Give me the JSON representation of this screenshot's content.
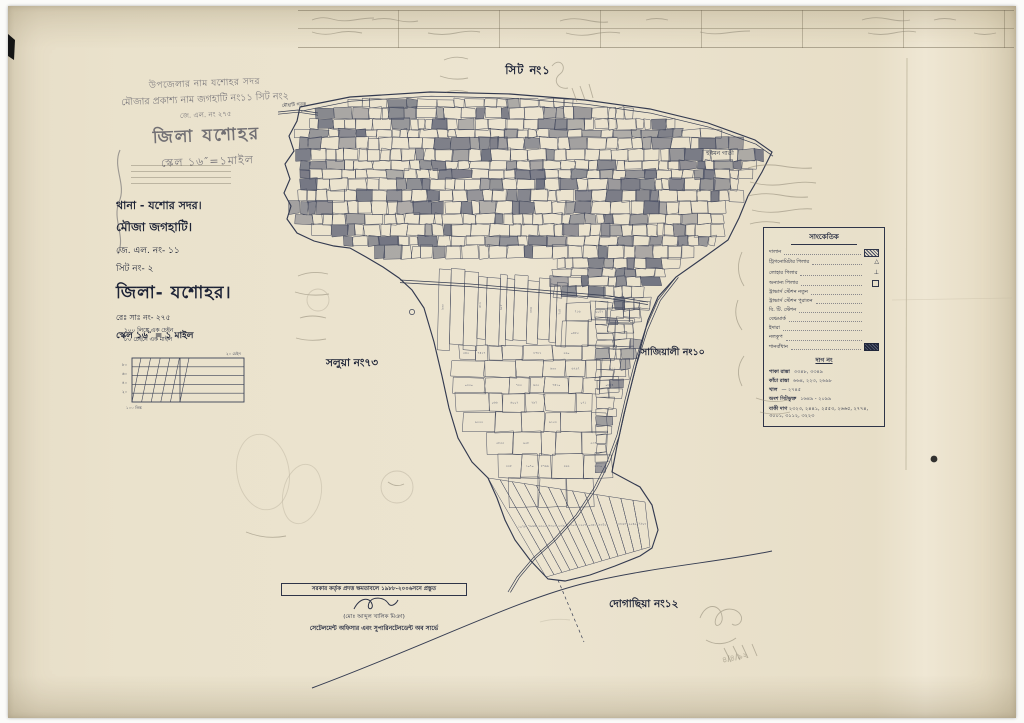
{
  "page": {
    "paper_color": "#eae2cc",
    "ink_color": "#343a50",
    "pencil_color": "#8d8673"
  },
  "stamp_top": {
    "line1": "উপজেলার নাম যশোহর সদর",
    "line2": "মৌজার প্রকাশ্য নাম জগহাটি নং১১ সিট নং২",
    "line3": "জে. এল. নং ২৭৫",
    "title": "জিলা যশোহর",
    "scale": "স্কেল ১৬″=১মাইল"
  },
  "info_block": {
    "thana": "থানা - যশোর সদর।",
    "mouza": "মৌজা    জগহাটি।",
    "jl_no": "জে. এল. নং-    ১১",
    "sheet_no": "সিট নং-    ২",
    "district": "জিলা- যশোহর।",
    "resurvey_no": "রেঃ সাঃ নং- ২৭৫",
    "scale": "স্কেল ১৬″ = ১ মাইল"
  },
  "scale_bar": {
    "line1": "১০০ লিঙ্কে এক চেইন",
    "line2": "৮০ চেইনে এক মাইল",
    "left_ticks": [
      "৮০",
      "৬০",
      "৪০",
      "২০"
    ],
    "bottom_label": "১০০ লিঙ্ক",
    "right_label": "২০ চেইন"
  },
  "sheet_label": "সিট নং১",
  "map": {
    "road_label": "মৌহাটি সড়ক",
    "village_label": "হুরমন গাতী",
    "neighbors": [
      {
        "name": "সলুয়া নং৭৩"
      },
      {
        "name": "সাজিয়ালী নং১০"
      },
      {
        "name": "দোগাছিয়া নং১২"
      }
    ],
    "pencil_date": "৪/৪/৯২"
  },
  "legend": {
    "title": "সাংকেতিক",
    "items": [
      {
        "label": "দালান",
        "symbol": "hatch"
      },
      {
        "label": "ট্রিগনোমিটার পিলার",
        "symbol": "triangle"
      },
      {
        "label": "লোহার পিলার",
        "symbol": "iron-pillar"
      },
      {
        "label": "অন্যান্য পিলার",
        "symbol": "square"
      },
      {
        "label": "ট্রাভার্স স্টেশন নতুন",
        "symbol": "dots"
      },
      {
        "label": "ট্রাভার্স স্টেশন পুরাতন",
        "symbol": "dots"
      },
      {
        "label": "বি. টি. স্টেশন",
        "symbol": "dots"
      },
      {
        "label": "বেঞ্চমার্ক",
        "symbol": "dots"
      },
      {
        "label": "ইদারা",
        "symbol": "dots"
      },
      {
        "label": "নলকূপ",
        "symbol": "dots"
      },
      {
        "label": "শানবাঁধান",
        "symbol": "hatch-dark"
      }
    ],
    "dag_header": "দাগ নং",
    "dag_rows": [
      {
        "label": "পাকা রাস্তা",
        "value": "৩৩৪৮, ৩৩৪৯"
      },
      {
        "label": "কাঁচা রাস্তা",
        "value": "৬৬৪, ২২৩, ২৬৯৮"
      },
      {
        "label": "খাল",
        "value": "— ২৭৪৫"
      },
      {
        "label": "অংশ সিটভুক্ত",
        "value": "১৬৪৯ - ২০৯৯"
      }
    ],
    "baki_dag": {
      "label": "বাকী দাগ",
      "value": "২৩২৩, ২৪৪১, ২৫৫৩, ২৬৬৫, ২৭৭৪, ৩০০১, ৩১১২, ৩২২৩"
    }
  },
  "certificate": {
    "line1": "সরকার কর্তৃক প্রদত্ত ক্ষমতাবলে ১৯৮৮-২০০৬সনে প্রস্তুত",
    "name": "(মোঃ আব্দুল খালিক মিঞা)",
    "designation": "সেটেলমেন্ট অফিসার এবং সুপারিনটেনডেন্ট অব সার্ভে"
  }
}
